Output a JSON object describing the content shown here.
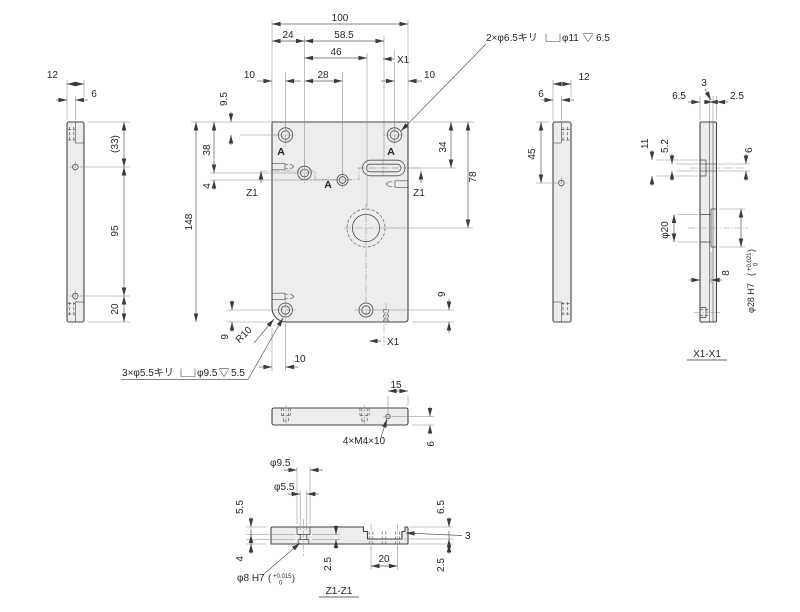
{
  "front": {
    "d100": "100",
    "d24": "24",
    "d58_5": "58.5",
    "d46": "46",
    "d28": "28",
    "d10_left": "10",
    "d10_right": "10",
    "d10_bottom": "10",
    "d9_5": "9.5",
    "d38": "38",
    "d4": "4",
    "d148": "148",
    "d9_bottom_left": "9",
    "d34": "34",
    "d78": "78",
    "d9_bottom_right": "9",
    "hole_label_a": "A",
    "r10": "R10"
  },
  "left_view": {
    "d12": "12",
    "d6": "6",
    "d33": "(33)",
    "d95": "95",
    "d20": "20"
  },
  "right_view": {
    "d12": "12",
    "d6": "6",
    "d45": "45"
  },
  "bottom_view": {
    "d15": "15",
    "d6": "6",
    "tap_callout": "4×M4×10"
  },
  "x1_section": {
    "title": "X1-X1",
    "d3": "3",
    "d6_5": "6.5",
    "d2_5": "2.5",
    "d11": "11",
    "d5_2": "5.2",
    "d6": "6",
    "phi20": "φ20",
    "d8": "8",
    "bore": {
      "main": "φ28 H7",
      "paren_open": "(",
      "tol_upper": "+0.021",
      "tol_lower": "0",
      "paren_close": ")"
    }
  },
  "z1_section": {
    "title": "Z1-Z1",
    "phi9_5": "φ9.5",
    "phi5_5": "φ5.5",
    "d5_5": "5.5",
    "d4": "4",
    "d2_5_mid": "2.5",
    "d20": "20",
    "d6_5": "6.5",
    "d3": "3",
    "d2_5_right": "2.5",
    "fit": {
      "main": "φ8 H7",
      "paren_open": "(",
      "tol_upper": "+0.015",
      "tol_lower": "0",
      "paren_close": ")"
    }
  },
  "callouts": {
    "cbore_top": {
      "prefix": "2×φ6.5キリ",
      "bore": "φ11",
      "depth": "6.5"
    },
    "cbore_bottom": {
      "prefix": "3×φ5.5キリ",
      "bore": "φ9.5",
      "depth": "5.5"
    }
  },
  "section_marks": {
    "x1": "X1",
    "z1": "Z1"
  }
}
